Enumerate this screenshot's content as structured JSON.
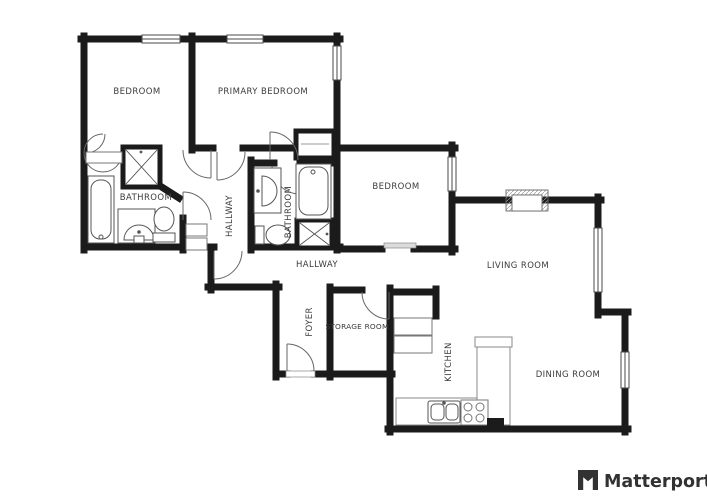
{
  "plan": {
    "background": "#ffffff",
    "wall_color": "#1b1b1b",
    "fixture_line_color": "#555555",
    "label_color": "#3b3b3b",
    "rooms": [
      {
        "id": "bedroom-1",
        "label": "BEDROOM"
      },
      {
        "id": "primary-bedroom",
        "label": "PRIMARY BEDROOM"
      },
      {
        "id": "bathroom-1",
        "label": "BATHROOM"
      },
      {
        "id": "hallway-1",
        "label": "HALLWAY"
      },
      {
        "id": "bathroom-2",
        "label": "BATHROOM"
      },
      {
        "id": "bedroom-2",
        "label": "BEDROOM"
      },
      {
        "id": "hallway-2",
        "label": "HALLWAY"
      },
      {
        "id": "living-room",
        "label": "LIVING ROOM"
      },
      {
        "id": "foyer",
        "label": "FOYER"
      },
      {
        "id": "storage-room",
        "label": "STORAGE ROOM"
      },
      {
        "id": "kitchen",
        "label": "KITCHEN"
      },
      {
        "id": "dining-room",
        "label": "DINING ROOM"
      }
    ],
    "fixture_icons": [
      "closet-double-doors",
      "shower",
      "bathtub",
      "vanity-sink",
      "toilet",
      "linen-shelves",
      "door-swing",
      "window",
      "open-passage-sill",
      "fireplace",
      "storage-shelves",
      "kitchen-sink",
      "stove",
      "counter"
    ]
  },
  "branding": {
    "logo_text": "Matterport",
    "logo_color": "#323232"
  }
}
